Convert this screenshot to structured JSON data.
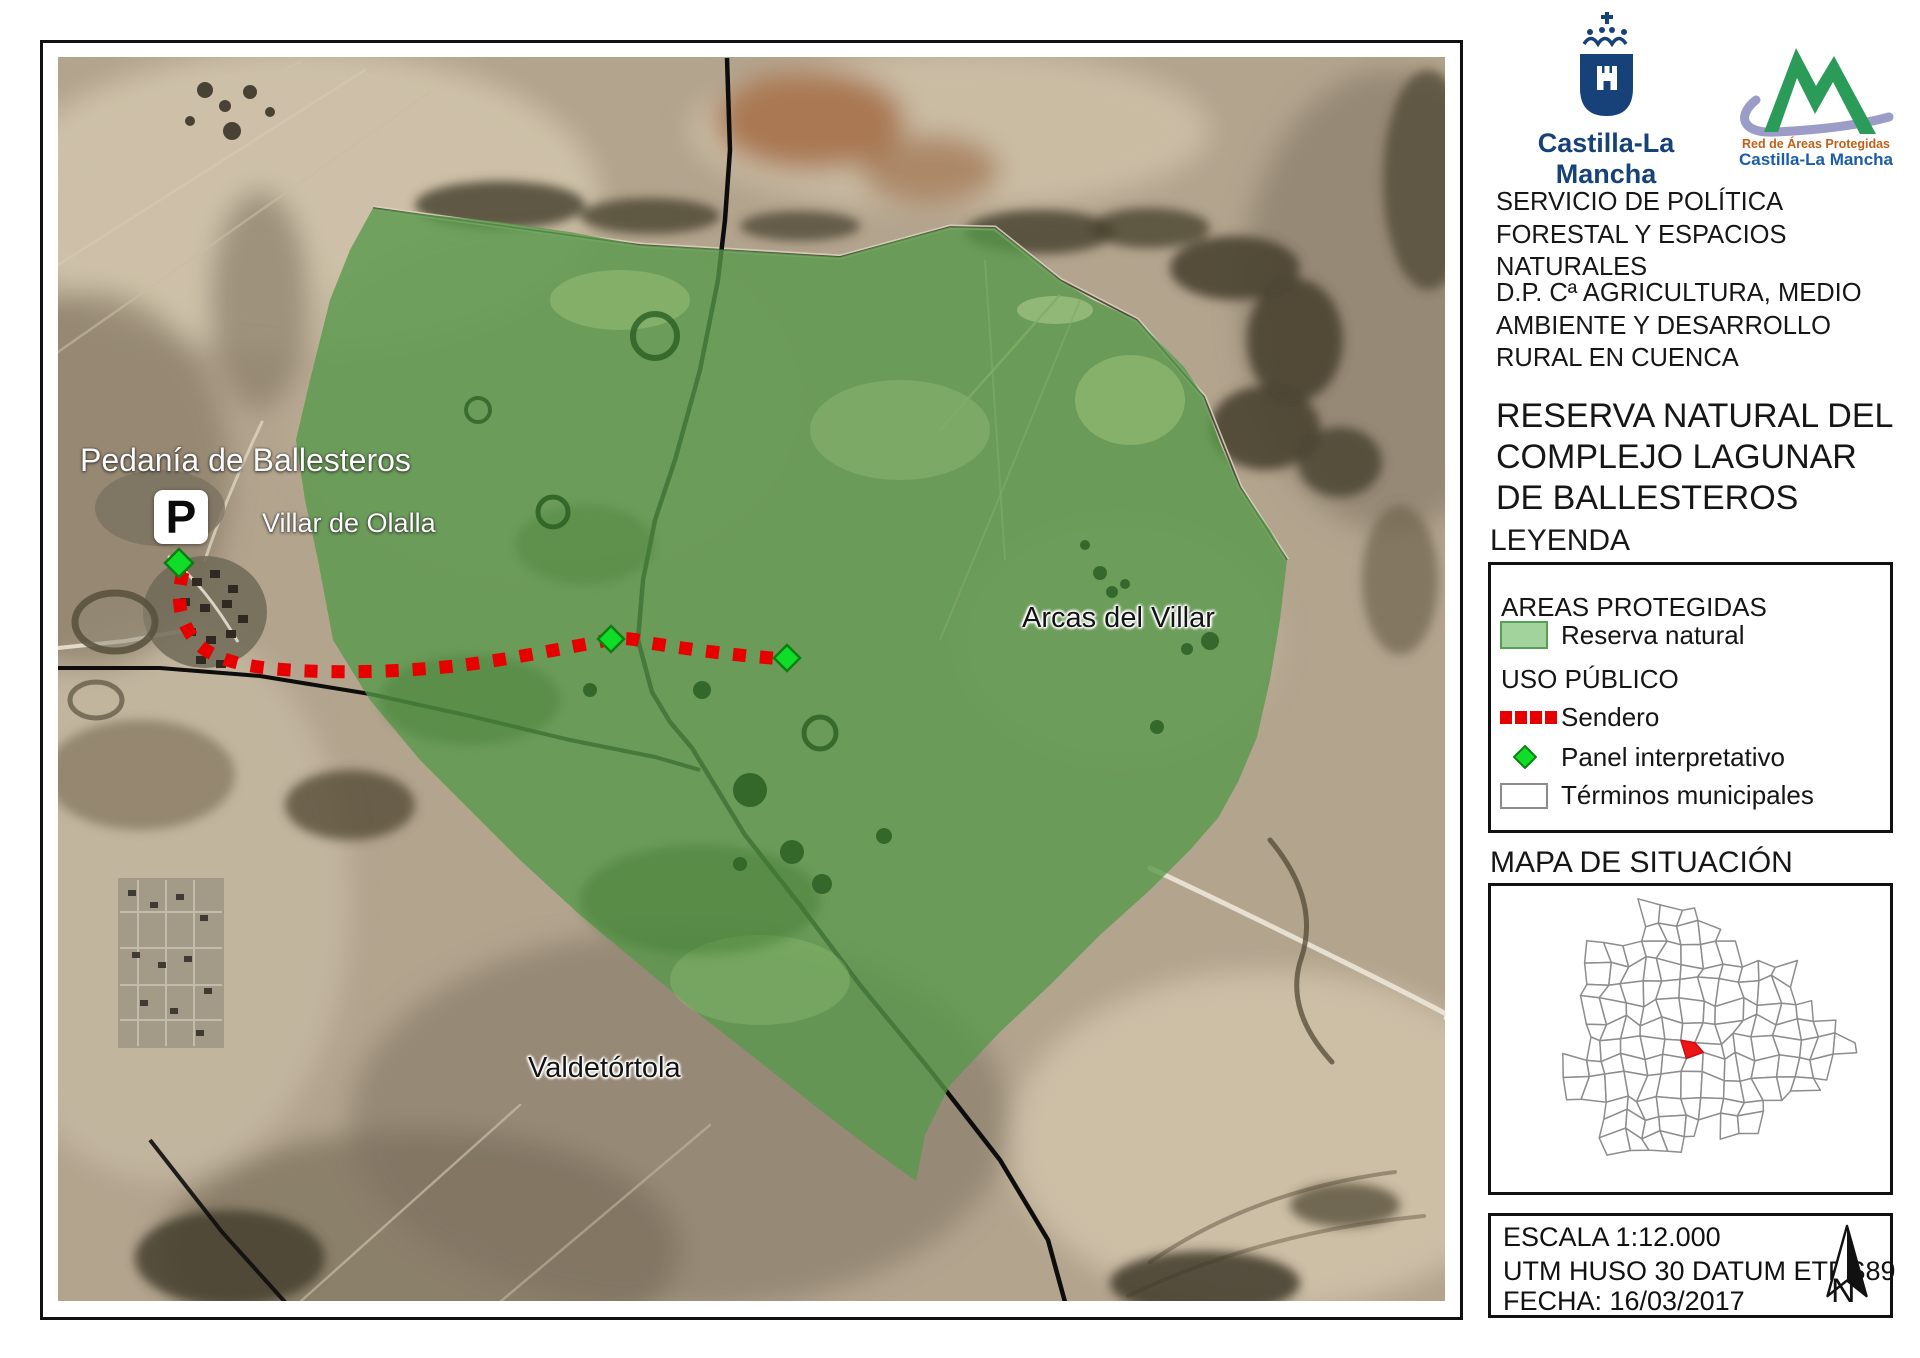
{
  "colors": {
    "reserve_fill_green": "#57984a",
    "reserve_swatch_fill": "#a3d39c",
    "reserve_swatch_border": "#56a056",
    "sendero_red": "#e60000",
    "panel_green": "#0fdd28",
    "terminos_border_gray": "#8a8a8a",
    "brand_navy": "#164279",
    "rap_mountain_green": "#2a9b58",
    "rap_swoosh_lavender": "#9b9cc8",
    "rap_orange": "#c06018",
    "rap_blue": "#1c5cab",
    "selected_municipality_red": "#ee1515"
  },
  "branding": {
    "clm_wordmark": "Castilla-La Mancha",
    "rap_line1": "Red de Áreas Protegidas",
    "rap_line2": "Castilla-La Mancha"
  },
  "sidebar": {
    "service": "SERVICIO DE POLÍTICA FORESTAL Y ESPACIOS NATURALES",
    "department": "D.P. Cª AGRICULTURA, MEDIO AMBIENTE Y DESARROLLO RURAL EN CUENCA",
    "title": "RESERVA NATURAL DEL COMPLEJO LAGUNAR DE BALLESTEROS",
    "legend": {
      "heading": "LEYENDA",
      "group_areas": "AREAS PROTEGIDAS",
      "reserva": "Reserva natural",
      "group_uso": "USO PÚBLICO",
      "sendero": "Sendero",
      "panel": "Panel interpretativo",
      "terminos": "Términos municipales"
    },
    "situacion_heading": "MAPA DE SITUACIÓN",
    "info": {
      "escala": "ESCALA 1:12.000",
      "utm": "UTM HUSO 30 DATUM ETRS89",
      "fecha": "FECHA: 16/03/2017",
      "north": "N"
    }
  },
  "map": {
    "labels": {
      "pedania": "Pedanía de Ballesteros",
      "villar": "Villar de Olalla",
      "arcas": "Arcas del Villar",
      "valdetortola": "Valdetórtola"
    },
    "parking_label": "P"
  }
}
